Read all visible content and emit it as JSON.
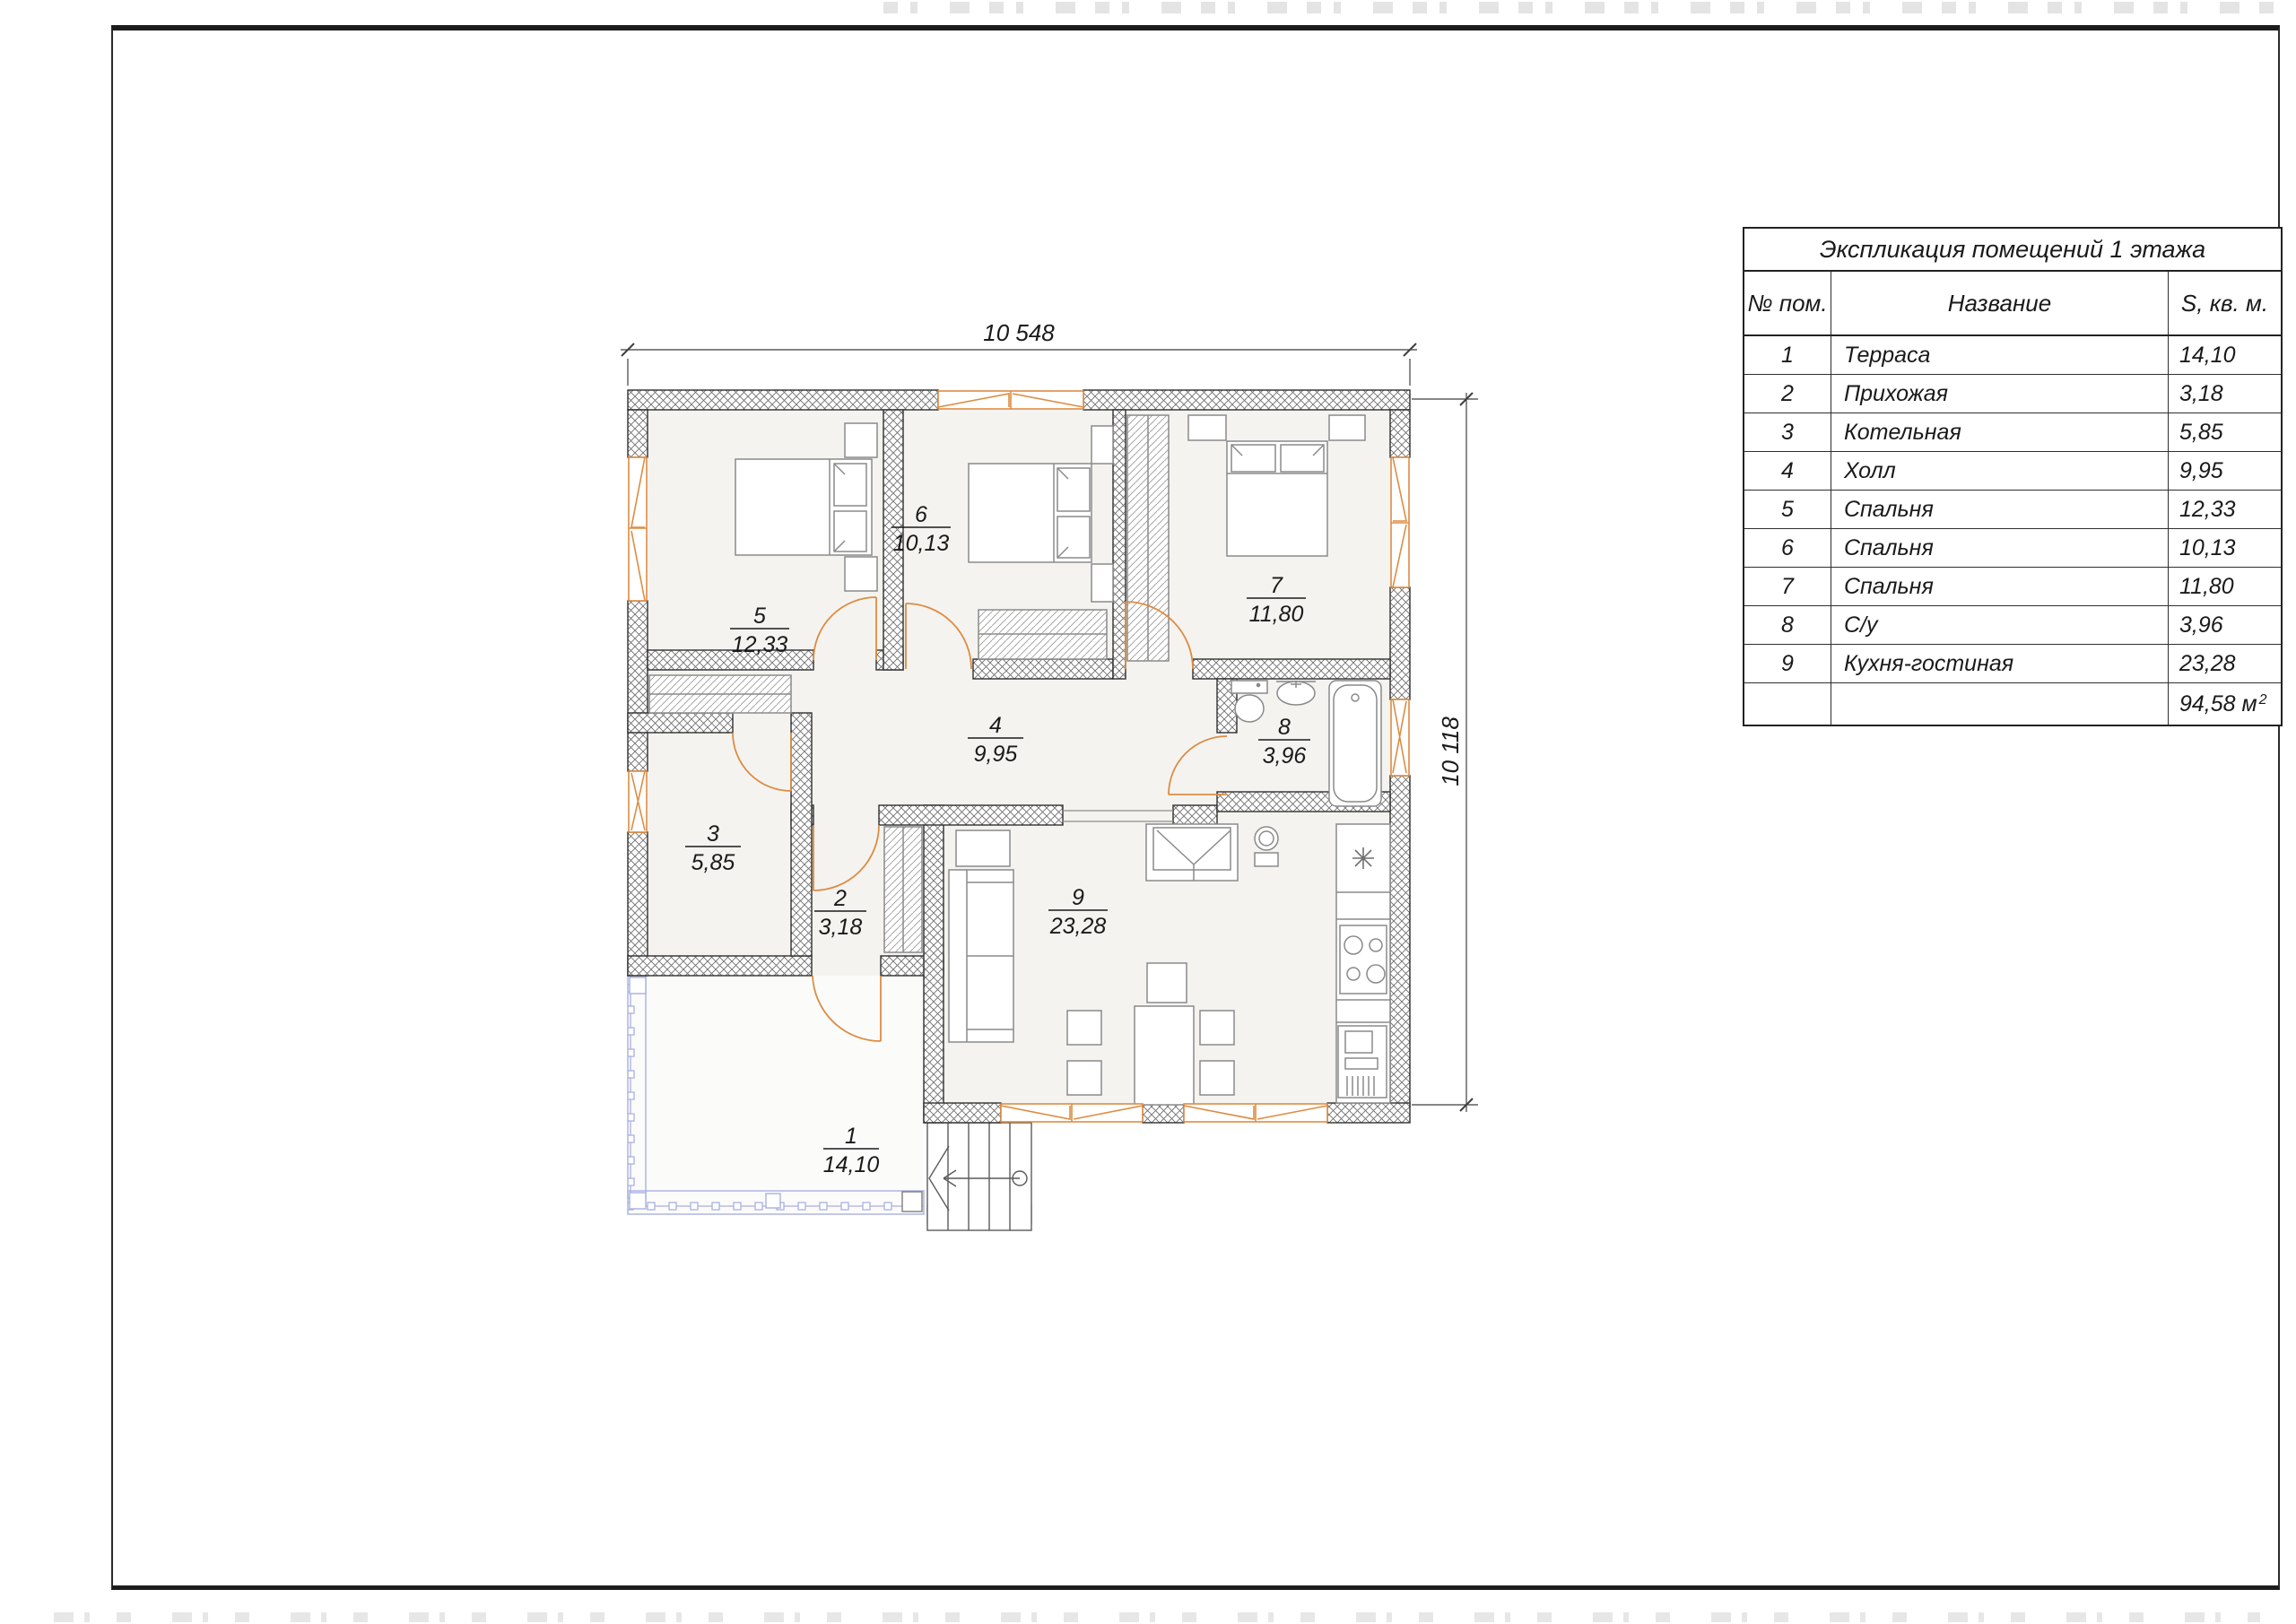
{
  "dimensions": {
    "top": "10 548",
    "right": "10 118"
  },
  "table": {
    "title": "Экспликация помещений 1 этажа",
    "headers": {
      "num": "№ пом.",
      "name": "Название",
      "area": "S, кв. м."
    },
    "rows": [
      {
        "num": "1",
        "name": "Терраса",
        "area": "14,10"
      },
      {
        "num": "2",
        "name": "Прихожая",
        "area": "3,18"
      },
      {
        "num": "3",
        "name": "Котельная",
        "area": "5,85"
      },
      {
        "num": "4",
        "name": "Холл",
        "area": "9,95"
      },
      {
        "num": "5",
        "name": "Спальня",
        "area": "12,33"
      },
      {
        "num": "6",
        "name": "Спальня",
        "area": "10,13"
      },
      {
        "num": "7",
        "name": "Спальня",
        "area": "11,80"
      },
      {
        "num": "8",
        "name": "С/у",
        "area": "3,96"
      },
      {
        "num": "9",
        "name": "Кухня-гостиная",
        "area": "23,28"
      }
    ],
    "total": {
      "value": "94,58 м",
      "sup": "2"
    }
  },
  "plan": {
    "rooms": [
      {
        "num": "1",
        "area": "14,10"
      },
      {
        "num": "2",
        "area": "3,18"
      },
      {
        "num": "3",
        "area": "5,85"
      },
      {
        "num": "4",
        "area": "9,95"
      },
      {
        "num": "5",
        "area": "12,33"
      },
      {
        "num": "6",
        "area": "10,13"
      },
      {
        "num": "7",
        "area": "11,80"
      },
      {
        "num": "8",
        "area": "3,96"
      },
      {
        "num": "9",
        "area": "23,28"
      }
    ]
  },
  "colors": {
    "window_door_orange": "#dd8c42",
    "railing_blue": "#a9b0e2",
    "wall_line": "#2f2f2f",
    "room_fill": "#f4f3f0",
    "furniture_gray": "#8a8a8a"
  }
}
